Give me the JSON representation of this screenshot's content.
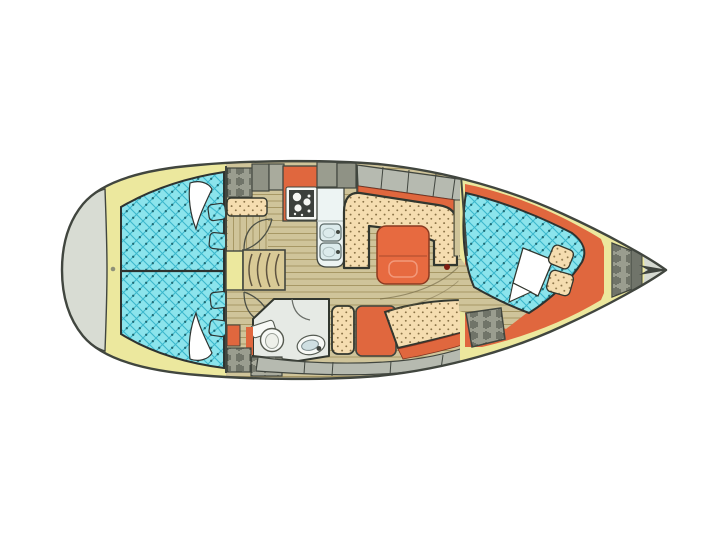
{
  "meta": {
    "diagram_type": "sailboat-interior-floor-plan",
    "view": "top-down, bow pointing right, stern at left",
    "visible_text": ""
  },
  "palette": {
    "background": "#ffffff",
    "hull_fill": "#ffffff",
    "hull_outline": "#41463f",
    "transom": "#d8dcd3",
    "deck_yellow": "#ece89e",
    "berth_quilt_base": "#8be4ec",
    "berth_quilt_line": "#3cb8cc",
    "berth_quilt_dot": "#1e6a74",
    "upholstery_base": "#f5ddb0",
    "upholstery_dot": "#8a7347",
    "accent_orange": "#e0673e",
    "table_orange": "#e76a40",
    "floor_base": "#cfc49a",
    "floor_line": "#a3935f",
    "steps_wood": "#d9ca96",
    "locker_grey": "#9a9d8f",
    "locker_grey_light": "#a9ab9d",
    "locker_grey_dark": "#8f9285",
    "side_deck_grey": "#b6bab0",
    "head_fill": "#e6eae5",
    "fixture_white": "#f7f9f6",
    "sink_blue": "#dcebec",
    "counter_white": "#edf4f3",
    "stove_panel": "#3c403c",
    "pillow_white": "#ffffff",
    "knob_red": "#7e1d12",
    "bow_deck": "#d5d9d1",
    "locker_cap": "#70746a"
  },
  "components": [
    "hull",
    "swim-platform-transom",
    "aft-double-berth",
    "aft-pillows",
    "aft-cushions",
    "companionway-steps",
    "cabin-door-swings",
    "galley-stove",
    "galley-double-sink",
    "galley-counters",
    "storage-lockers",
    "salon-u-settee",
    "salon-table",
    "starboard-settee",
    "head-toilet",
    "head-washbasin",
    "wardrobe",
    "v-berth",
    "v-berth-pillow",
    "anchor-locker",
    "bow-roller"
  ]
}
